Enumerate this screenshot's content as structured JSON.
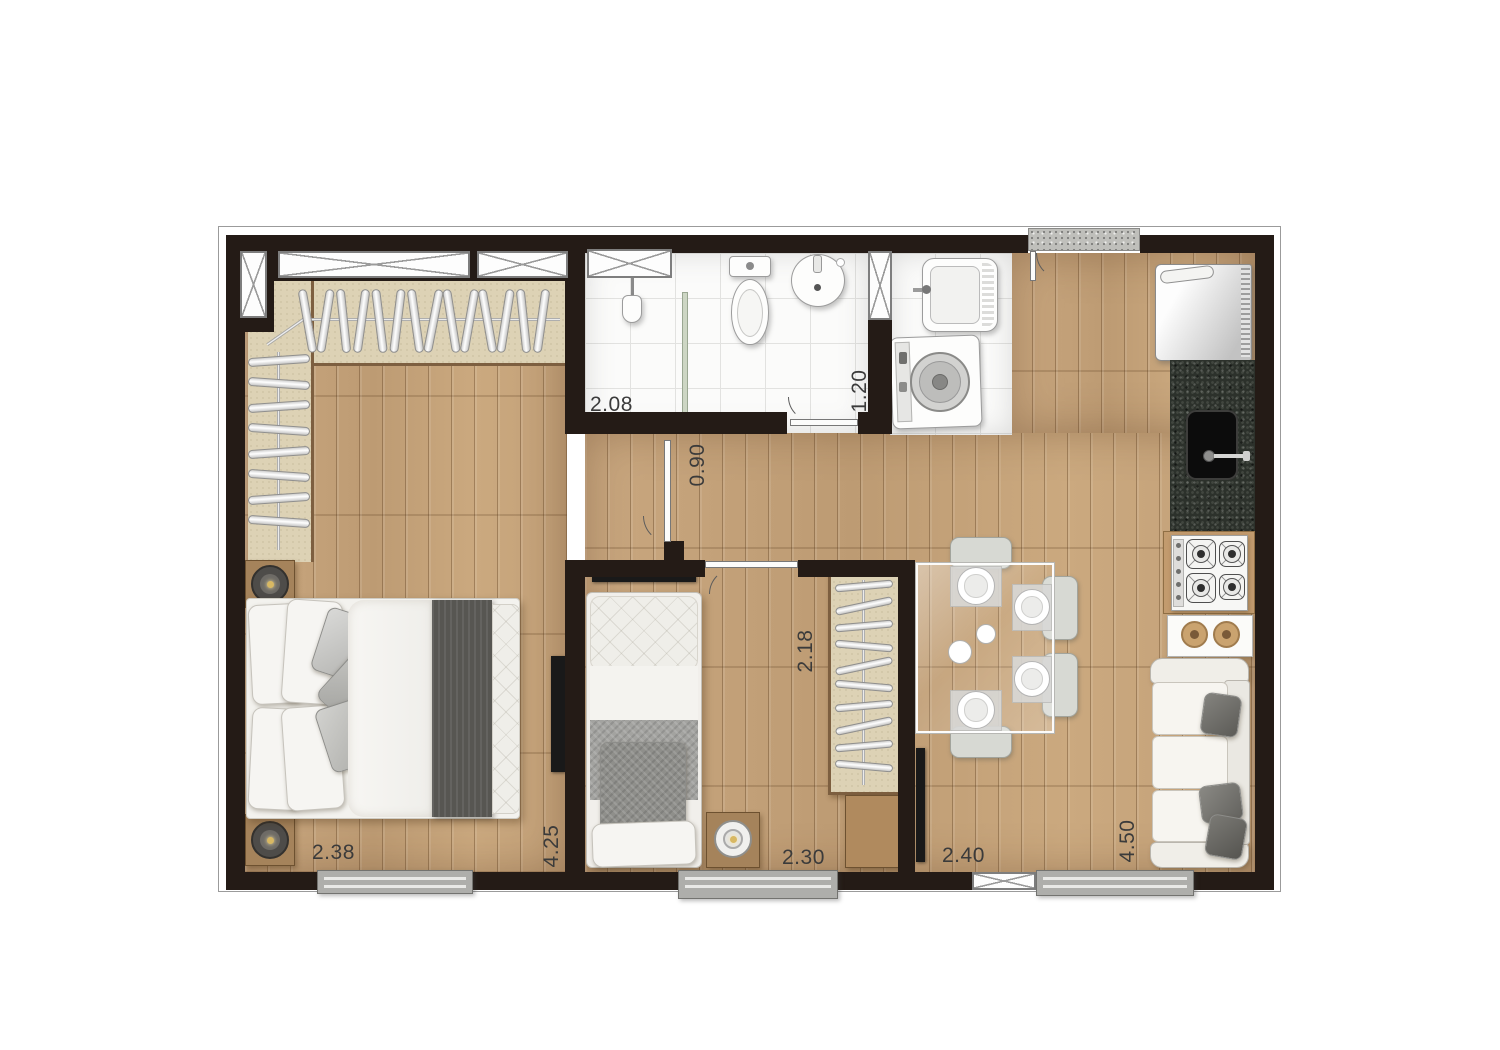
{
  "dimensions": {
    "shower_width": "2.08",
    "bathroom_width": "1.20",
    "hall_door": "0.90",
    "wardrobe_length": "2.18",
    "master_bedroom_width": "2.38",
    "master_bedroom_length": "4.25",
    "bedroom2_width": "2.30",
    "living_width": "2.40",
    "living_length": "4.50"
  },
  "fixtures": [
    "walk-in-closet",
    "shower",
    "toilet",
    "washbasin",
    "laundry-tub",
    "washing-machine",
    "refrigerator",
    "kitchen-sink",
    "cooktop",
    "dining-table",
    "dining-chairs",
    "sofa",
    "tv",
    "double-bed",
    "single-bed",
    "wardrobe",
    "nightstand"
  ],
  "colors": {
    "wall": "#241b16",
    "wood_floor": "#c5a37c",
    "closet_floor": "#ddd2b5",
    "tile": "#fbfbfa",
    "granite_counter": "#2c312b",
    "dimension_text": "#3b3b3b"
  }
}
